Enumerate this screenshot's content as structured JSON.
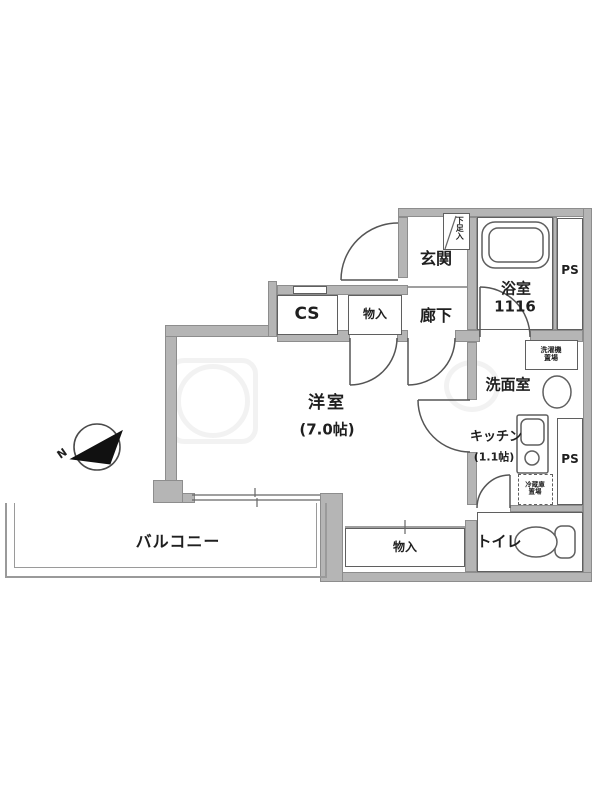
{
  "floorplan": {
    "compass": {
      "north_label": "N"
    },
    "rooms": {
      "entrance": {
        "label": "玄関"
      },
      "shoe_box": {
        "label": "下足入"
      },
      "hallway": {
        "label": "廊下"
      },
      "bathroom": {
        "label": "浴室",
        "size": "1116"
      },
      "pipe_space_top": {
        "label": "PS"
      },
      "pipe_space_bottom": {
        "label": "PS"
      },
      "closet_cs": {
        "label": "CS"
      },
      "storage_top": {
        "label": "物入"
      },
      "storage_bottom": {
        "label": "物入"
      },
      "western_room": {
        "label": "洋室",
        "size": "(7.0帖)"
      },
      "washroom": {
        "label": "洗面室"
      },
      "washer_area": {
        "line1": "洗濯機",
        "line2": "置場"
      },
      "kitchen": {
        "label": "キッチン",
        "size": "(1.1帖)"
      },
      "fridge_area": {
        "line1": "冷蔵庫",
        "line2": "置場"
      },
      "toilet": {
        "label": "トイレ"
      },
      "balcony": {
        "label": "バルコニー"
      }
    },
    "colors": {
      "wall_fill": "#b5b5b5",
      "line": "#555555",
      "compass_fill": "#111111"
    }
  }
}
